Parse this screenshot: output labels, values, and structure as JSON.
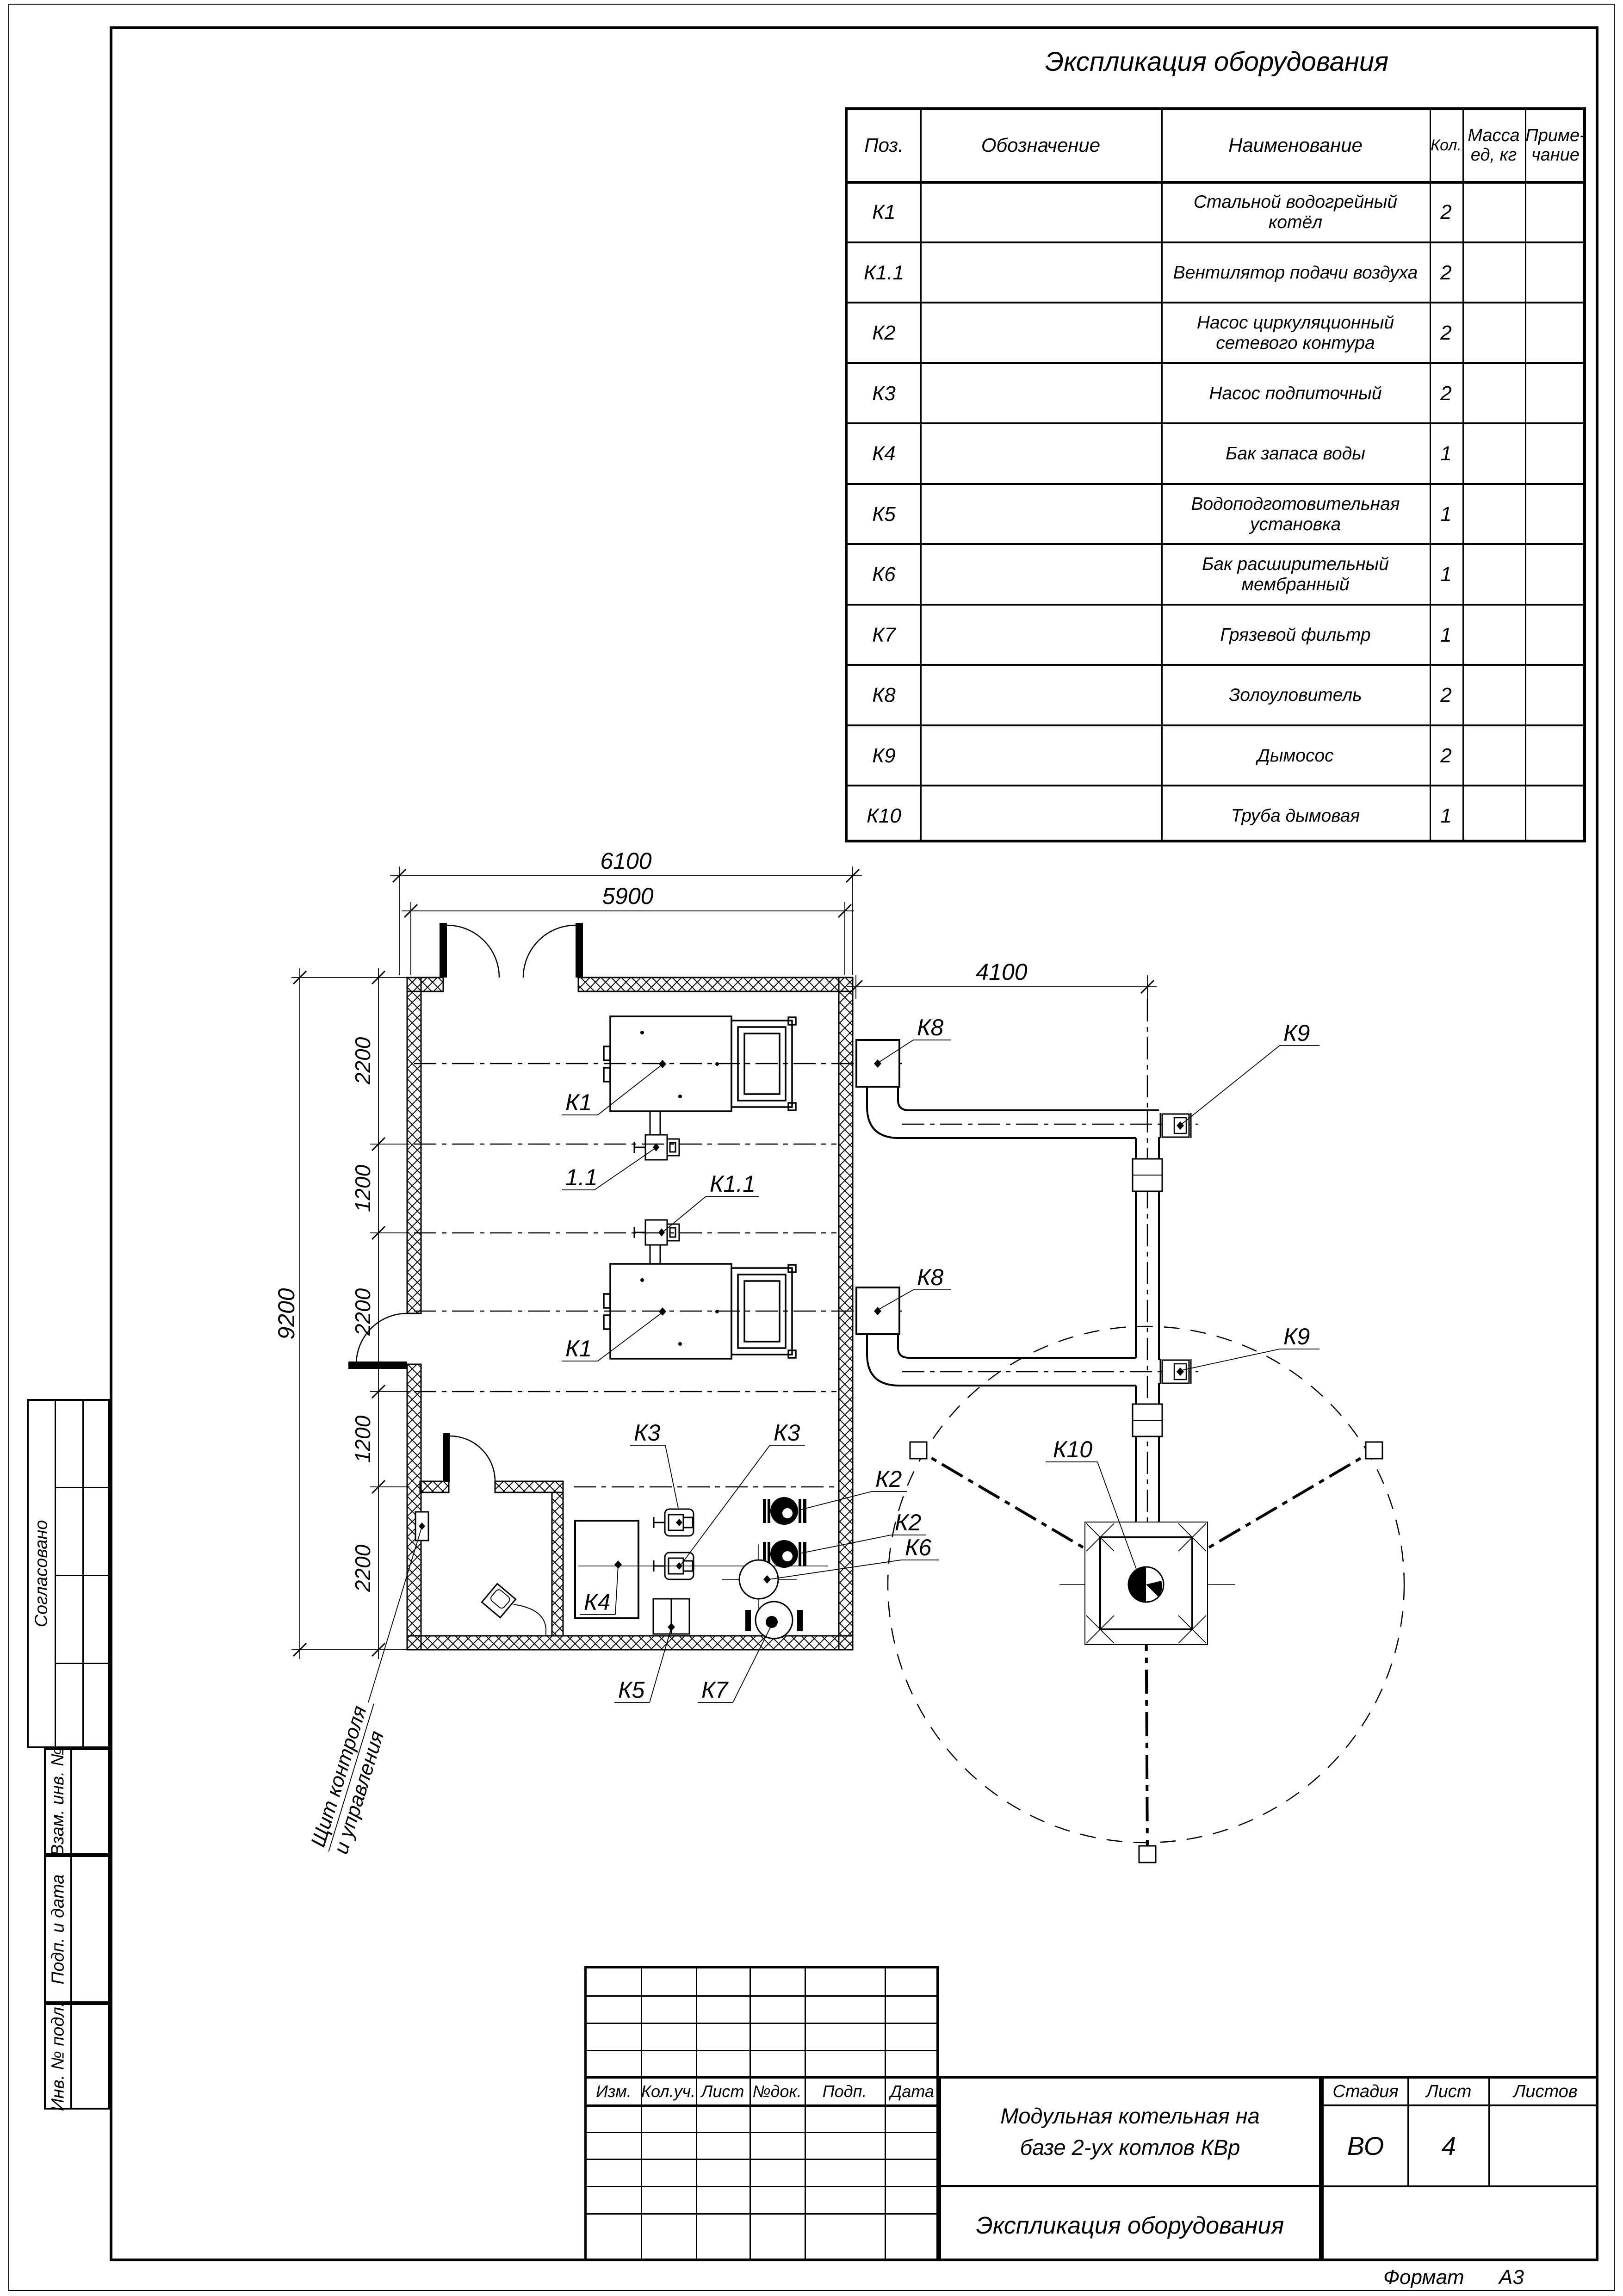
{
  "sheet": {
    "format_label": "Формат",
    "format_value": "А3"
  },
  "spec_table": {
    "title": "Экспликация оборудования",
    "headers": {
      "pos": "Поз.",
      "designation": "Обозначение",
      "name": "Наименование",
      "qty": "Кол.",
      "mass_line1": "Масса",
      "mass_line2": "ед, кг",
      "note_line1": "Приме-",
      "note_line2": "чание"
    },
    "rows": [
      {
        "pos": "К1",
        "name": "Стальной водогрейный котёл",
        "qty": "2"
      },
      {
        "pos": "К1.1",
        "name": "Вентилятор подачи воздуха",
        "qty": "2"
      },
      {
        "pos": "К2",
        "name": "Насос циркуляционный сетевого контура",
        "qty": "2"
      },
      {
        "pos": "К3",
        "name": "Насос подпиточный",
        "qty": "2"
      },
      {
        "pos": "К4",
        "name": "Бак запаса воды",
        "qty": "1"
      },
      {
        "pos": "К5",
        "name": "Водоподготовительная установка",
        "qty": "1"
      },
      {
        "pos": "К6",
        "name": "Бак расширительный мембранный",
        "qty": "1"
      },
      {
        "pos": "К7",
        "name": "Грязевой фильтр",
        "qty": "1"
      },
      {
        "pos": "К8",
        "name": "Золоуловитель",
        "qty": "2"
      },
      {
        "pos": "К9",
        "name": "Дымосос",
        "qty": "2"
      },
      {
        "pos": "К10",
        "name": "Труба дымовая",
        "qty": "1"
      }
    ]
  },
  "plan": {
    "dimensions": {
      "d6100": "6100",
      "d5900": "5900",
      "d4100": "4100",
      "d9200": "9200",
      "c1": "2200",
      "c2": "1200",
      "c3": "2200",
      "c4": "1200",
      "c5": "2200"
    },
    "labels": {
      "k1a": "К1",
      "k1b": "К1",
      "f11": "1.1",
      "k11": "К1.1",
      "k2a": "К2",
      "k2b": "К2",
      "k3a": "К3",
      "k3b": "К3",
      "k4": "К4",
      "k5": "К5",
      "k6": "К6",
      "k7": "К7",
      "k8a": "К8",
      "k8b": "К8",
      "k9a": "К9",
      "k9b": "К9",
      "k10": "К10"
    },
    "annotations": {
      "control_line1": "Щит контроля",
      "control_line2": "и управления"
    }
  },
  "title_block": {
    "col1": "Изм.",
    "col2": "Кол.уч.",
    "col3": "Лист",
    "col4": "№док.",
    "col5": "Подп.",
    "col6": "Дата",
    "project_name_line1": "Модульная котельная на",
    "project_name_line2": "базе 2-ух котлов КВр",
    "doc_title": "Экспликация оборудования",
    "stage_label": "Стадия",
    "sheet_label": "Лист",
    "sheets_label": "Листов",
    "stage_value": "ВО",
    "sheet_value": "4",
    "sheets_value": ""
  },
  "sidebar": {
    "agreed": "Согласовано",
    "replace_inv": "Взам. инв. №",
    "sign_date": "Подп. и дата",
    "inv_orig": "Инв. № подл."
  }
}
